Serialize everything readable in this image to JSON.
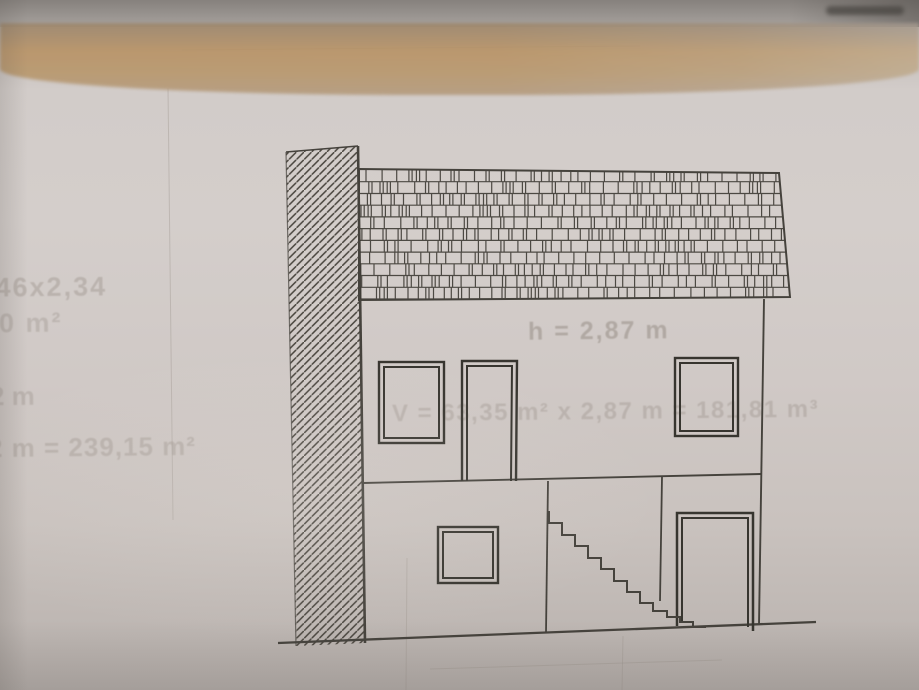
{
  "colors": {
    "paper": "#d0cac7",
    "ink": "#45423c",
    "frame": "#37352f",
    "shingle": "#3e3b35",
    "bleed": "#857b72",
    "tan_band": "#d8bf9b",
    "top_strip": "#98938f"
  },
  "bleed_texts": {
    "height_label": "h = 2,87 m",
    "volume_formula": "V = 63,35 m² x 2,87 m = 181,81 m³",
    "margin_line1": ",46x2,34",
    "margin_line2": "90 m²",
    "margin_line3": "2 m",
    "margin_line4": "2 m = 239,15 m²"
  }
}
